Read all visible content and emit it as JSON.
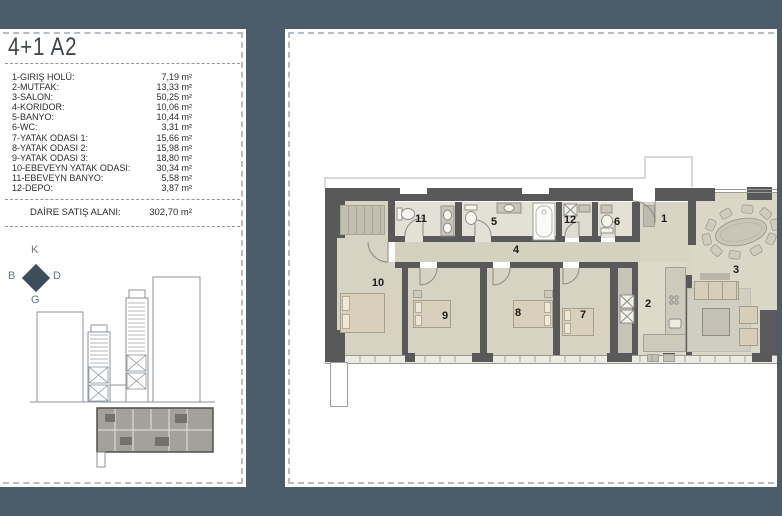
{
  "colors": {
    "background": "#4d5c6b",
    "panel": "#ffffff",
    "wall": "#595959",
    "floor": "#d8d5c5",
    "bath_floor": "#e3e0d6",
    "highlight_unit": "#a3a19a",
    "compass_diamond": "#3d4d5a"
  },
  "left_panel": {
    "title": "4+1 A2",
    "legend": [
      {
        "label": "1-GIRIŞ HOLÜ:",
        "value": "7,19 m²"
      },
      {
        "label": "2-MUTFAK:",
        "value": "13,33 m²"
      },
      {
        "label": "3-SALON:",
        "value": "50,25 m²"
      },
      {
        "label": "4-KORIDOR:",
        "value": "10,06 m²"
      },
      {
        "label": "5-BANYO:",
        "value": "10,44 m²"
      },
      {
        "label": "6-WC:",
        "value": "3,31 m²"
      },
      {
        "label": "7-YATAK ODASI 1:",
        "value": "15,66 m²"
      },
      {
        "label": "8-YATAK ODASI 2:",
        "value": "15,98 m²"
      },
      {
        "label": "9-YATAK ODASI 3:",
        "value": "18,80 m²"
      },
      {
        "label": "10-EBEVEYN YATAK ODASI:",
        "value": "30,34 m²"
      },
      {
        "label": "11-EBEVEYN BANYO:",
        "value": "5,58 m²"
      },
      {
        "label": "12-DEPO:",
        "value": "3,87 m²"
      }
    ],
    "total": {
      "label": "DAİRE SATIŞ ALANI:",
      "value": "302,70 m²"
    },
    "compass": {
      "north": "K",
      "west": "B",
      "east": "D",
      "south": "G"
    }
  },
  "floor_plan": {
    "room_numbers": {
      "r1": "1",
      "r2": "2",
      "r3": "3",
      "r4": "4",
      "r5": "5",
      "r6": "6",
      "r7": "7",
      "r8": "8",
      "r9": "9",
      "r10": "10",
      "r11": "11",
      "r12": "12"
    }
  }
}
